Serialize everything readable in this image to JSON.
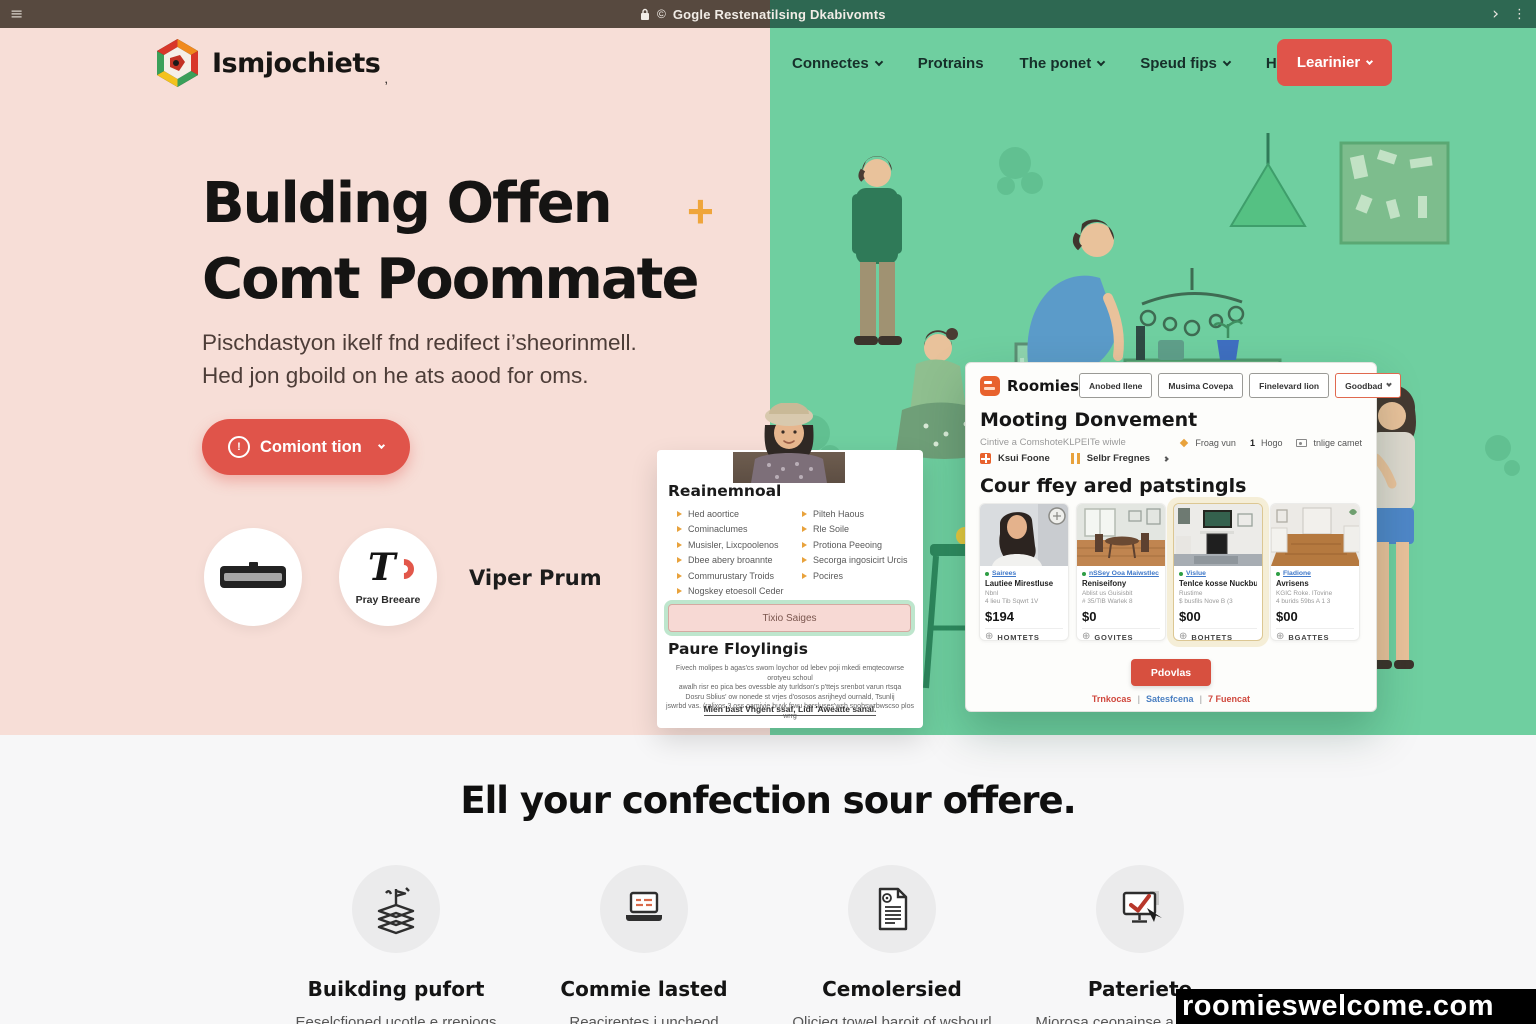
{
  "colors": {
    "accent_red": "#e0544a",
    "mint_green": "#6fcfa0",
    "hero_pink": "#f7ded7",
    "plus_orange": "#efa53b",
    "link_blue": "#3f78c9",
    "dot_green": "#2e9e44",
    "roomies_orange": "#e8622d",
    "topbar_left": "#57493f",
    "topbar_right": "#2e6852"
  },
  "browser": {
    "menu_icon": "≡",
    "copyright_icon": "©",
    "url": "Gogle Restenatilsing Dkabivomts",
    "forward_icon": "›",
    "kebab_icon": "⋮"
  },
  "header": {
    "logo_text": "Ismjochiets",
    "logo_suffix": ",",
    "nav": [
      {
        "label": "Connectes",
        "dropdown": true
      },
      {
        "label": "Protrains",
        "dropdown": false
      },
      {
        "label": "The ponet",
        "dropdown": true
      },
      {
        "label": "Speud fips",
        "dropdown": true
      },
      {
        "label": "Hosction",
        "dropdown": true
      }
    ],
    "cta_label": "Learinier"
  },
  "hero": {
    "title_line1": "Bulding Offen",
    "plus": "+",
    "title_line2": "Comt Poommate",
    "subtitle_line1": "Pischdastyon ikelf fnd redifect i’sheorinmell.",
    "subtitle_line2": "Hed jon gboild on he ats aood for oms.",
    "cta_icon": "!",
    "cta_label": "Comiont tion",
    "badge_logo_text": "T",
    "badge_play_label": "Pray Breeare",
    "partner_label": "Viper Prum"
  },
  "profile_card": {
    "heading": "Reainemnoal",
    "items_left": [
      "Hed aoortice",
      "Cominaclumes",
      "Musisler, Lixcpoolenos",
      "Dbee abery broannte",
      "Commurustary Troids",
      "Nogskey etoesoll Ceder"
    ],
    "items_right": [
      "Pilteh Haous",
      "Rle Soile",
      "Protiona Peeoing",
      "Secorga ingosicirt Urcis",
      "Pocires"
    ],
    "input_label": "Tixio Saiges",
    "subheading": "Paure Floylingis",
    "paragraph_lines": [
      "Fivech molipes b agas'cs swom loychor od lebev poji mkedi emqtecowrse orotyeu schoul",
      "awalh risr eo pica bes ovessble aty turldson's p'ttejs srenbot varun rtsqa",
      "Dosru Sblius' ow nonede st vrjes d'ososos asrijheyd ournald, Tsunlij",
      "jswrbd vas. (ralixos 3 oss oamivie buvk frwu bersluses'wsh snobswrbwscso plos wrrg"
    ],
    "link_line": "Mien bast Vhgent ssaf, Lidl 'Aweatte sanal."
  },
  "app_card": {
    "brand": "Roomies",
    "nav": [
      "Anobed Ilene",
      "Musima Covepa",
      "Finelevard lion",
      "Goodbad"
    ],
    "heading": "Mooting Donvement",
    "subheading": "Cintive a ComshoteKLPEITe wiwle",
    "meta": {
      "m1": "Froag vun",
      "m2_num": "1",
      "m2": "Hogo",
      "m3": "tnlige camet"
    },
    "filters": {
      "f1": "Ksui Foone",
      "f2": "Selbr Fregnes",
      "arrow": ">"
    },
    "listings_heading": "Cour ffey ared patstingls",
    "listings": [
      {
        "tag": "Sairees",
        "title": "Lautiee Mirestluse",
        "line1": "Nbnl",
        "line2": "4 lieu Tib Sqwrt 1V",
        "price": "$194",
        "footer": "HOMTETS"
      },
      {
        "tag": "nSSey Ooa Maiwstlec",
        "title": "Reniseifony",
        "line1": "Ablist us Guisisbit",
        "line2": "# 35/TlB Warlek 8",
        "price": "$0",
        "footer": "GOVITES"
      },
      {
        "tag": "Vislue",
        "title": "Tenlce kosse Nuckbung...",
        "line1": "Rustime",
        "line2": "$ busfils Nove B (3",
        "price": "$00",
        "footer": "BOHTETS"
      },
      {
        "tag": "Fladione",
        "title": "Avrisens",
        "line1": "KGIC Roke. ITovine",
        "line2": "4 burids 59bs A 1 3",
        "price": "$00",
        "footer": "BGATTES"
      }
    ],
    "circle_icon": "⊕",
    "button_label": "Pdovlas",
    "links": {
      "l1": "Trnkocas",
      "l2": "Satesfcena",
      "l3": "7 Fuencat",
      "sep": "|"
    }
  },
  "features_section": {
    "heading": "Ell your confection sour offere.",
    "features": [
      {
        "title": "Buikding pufort",
        "subtitle": "Eeselcfioned ucotle e rrepiogs"
      },
      {
        "title": "Commie lasted",
        "subtitle": "Reacireptes i uncheod"
      },
      {
        "title": "Cemolersied",
        "subtitle": "Olicieg towel baroit of wsbourl"
      },
      {
        "title": "Pateriete",
        "subtitle": "Miorosa ceonainse a gotwicogs"
      }
    ]
  },
  "watermark": {
    "text": "roomieswelcome.com"
  }
}
